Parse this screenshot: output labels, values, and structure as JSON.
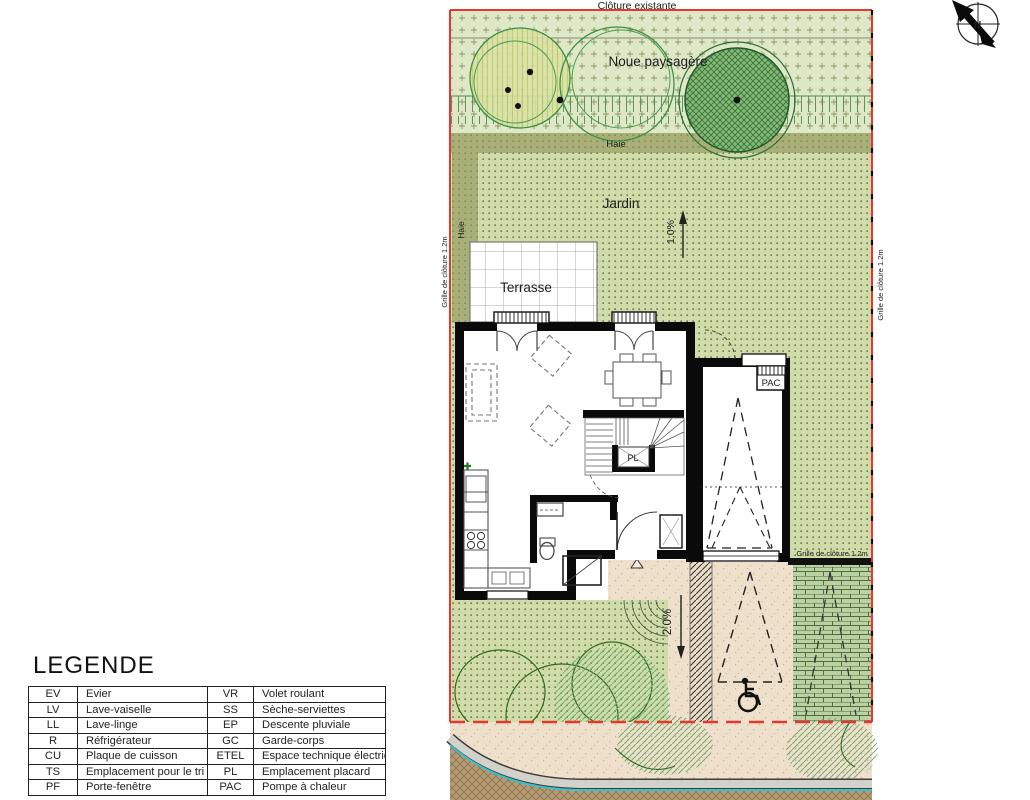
{
  "plan": {
    "labels": {
      "cloture_existante": "Clôture existante",
      "noue_paysagere": "Noue paysagère",
      "haie_top": "Haie",
      "haie_left": "Haie",
      "jardin": "Jardin",
      "terrasse": "Terrasse",
      "slope_top": "1.0%",
      "slope_bottom": "2.0%",
      "pl": "PL",
      "pac": "PAC",
      "grille_left": "Grille de clôture 1.2m",
      "grille_right": "Grille de clôture 1.2m",
      "grille_mid": "Grille de clôture 1.2m",
      "north_letter": "N"
    },
    "colors": {
      "boundary_red": "#e5372e",
      "jardin_green": "#cfdca9",
      "noue_green": "#dfe8c6",
      "haie_olive": "#a8b077",
      "tree_dark_green": "#2e6b34",
      "paver_green": "#bcd1a0",
      "driveway_beige": "#eee0cb",
      "street_brown": "#b49b73",
      "curb_cyan": "#35c2cc",
      "wall_black": "#0a0a0a"
    }
  },
  "legend": {
    "title": "LEGENDE",
    "rows": [
      [
        "EV",
        "Evier",
        "VR",
        "Volet roulant"
      ],
      [
        "LV",
        "Lave-vaiselle",
        "SS",
        "Sèche-serviettes"
      ],
      [
        "LL",
        "Lave-linge",
        "EP",
        "Descente pluviale"
      ],
      [
        "R",
        "Réfrigérateur",
        "GC",
        "Garde-corps"
      ],
      [
        "CU",
        "Plaque de cuisson",
        "ETEL",
        "Espace technique électrique"
      ],
      [
        "TS",
        "Emplacement pour le tri",
        "PL",
        "Emplacement placard"
      ],
      [
        "PF",
        "Porte-fenêtre",
        "PAC",
        "Pompe à chaleur"
      ]
    ]
  }
}
